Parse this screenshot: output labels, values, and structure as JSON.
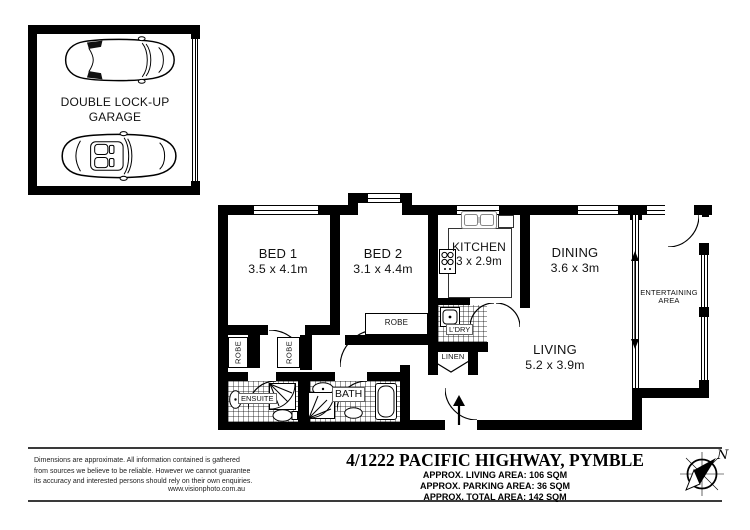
{
  "colors": {
    "wall": "#000000",
    "background": "#ffffff"
  },
  "garage": {
    "label_line1": "DOUBLE LOCK-UP",
    "label_line2": "GARAGE"
  },
  "rooms": {
    "bed1": {
      "name": "BED 1",
      "dims": "3.5 x 4.1m"
    },
    "bed2": {
      "name": "BED 2",
      "dims": "3.1 x 4.4m"
    },
    "kitchen": {
      "name": "KITCHEN",
      "dims": "3 x 2.9m"
    },
    "dining": {
      "name": "DINING",
      "dims": "3.6 x 3m"
    },
    "living": {
      "name": "LIVING",
      "dims": "5.2 x 3.9m"
    },
    "entertaining": {
      "line1": "ENTERTAINING",
      "line2": "AREA"
    }
  },
  "closets": {
    "robe": "ROBE",
    "linen": "LINEN",
    "laundry": "L'DRY",
    "ensuite": "ENSUITE",
    "bath": "BATH"
  },
  "footer": {
    "disclaimer_line1": "Dimensions are approximate. All information contained is gathered",
    "disclaimer_line2": "from sources we believe to be reliable. However we cannot guarantee",
    "disclaimer_line3": "its accuracy and interested persons should rely on their own enquiries.",
    "website": "www.visionphoto.com.au",
    "title": "4/1222 PACIFIC HIGHWAY, PYMBLE",
    "living_area": "APPROX. LIVING AREA: 106 SQM",
    "parking_area": "APPROX. PARKING AREA: 36 SQM",
    "total_area": "APPROX. TOTAL AREA: 142 SQM",
    "compass_letter": "N"
  }
}
